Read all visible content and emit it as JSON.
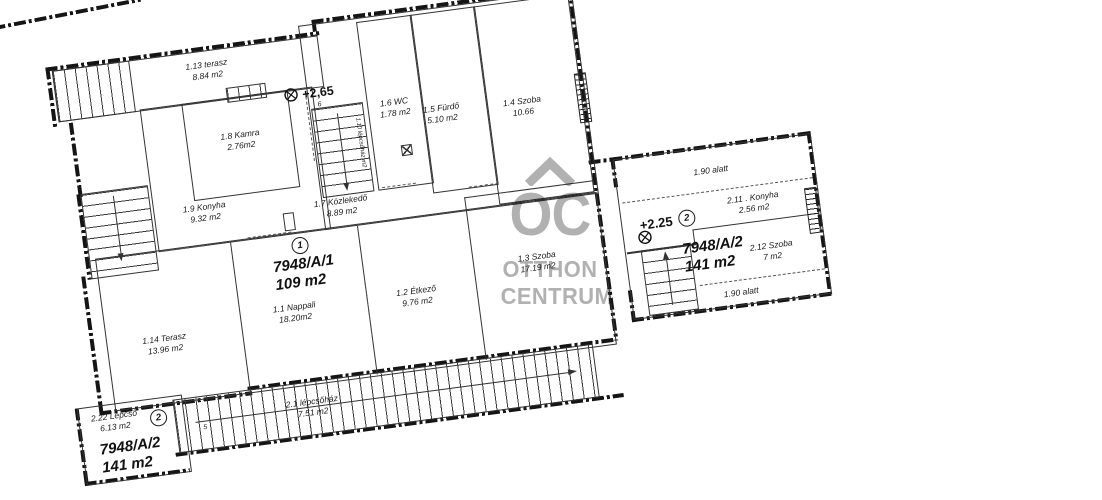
{
  "watermark": {
    "logo_text": "OC",
    "line1": "OTTHON",
    "line2": "CENTRUM",
    "color": "#b1b1b1"
  },
  "units": {
    "unit1": {
      "id": "7948/A/1",
      "area": "109 m2",
      "badge": "1",
      "level": "+2,65",
      "level_note": "6"
    },
    "unit2": {
      "id": "7948/A/2",
      "area": "141 m2",
      "badge": "2",
      "level": "+2.25"
    },
    "unit2_bottom": {
      "id": "7948/A/2",
      "area": "141 m2",
      "badge": "2"
    }
  },
  "rooms": {
    "terasz113": {
      "name": "1.13 terasz",
      "area": "8.84 m2"
    },
    "kamra18": {
      "name": "1.8 Kamra",
      "area": "2.76m2"
    },
    "konyha19": {
      "name": "1.9 Konyha",
      "area": "9.32 m2"
    },
    "lepcsohaz110": {
      "name": "1.10 lépcsőház",
      "area": "m2"
    },
    "wc16": {
      "name": "1.6 WC",
      "area": "1.78 m2"
    },
    "furdo15": {
      "name": "1.5 Fürdő",
      "area": "5.10 m2"
    },
    "szoba14": {
      "name": "1.4 Szoba",
      "area": "10.66"
    },
    "kozlekedo17": {
      "name": "1.7 Közlekedő",
      "area": "8.89 m2"
    },
    "nappali11": {
      "name": "1.1 Nappali",
      "area": "18.20m2"
    },
    "etkezo12": {
      "name": "1.2 Étkező",
      "area": "9.76 m2"
    },
    "szoba13": {
      "name": "1.3 Szoba",
      "area": "17.19 m2"
    },
    "terasz114": {
      "name": "1.14 Terasz",
      "area": "13.96 m2"
    },
    "lepcsohaz21": {
      "name": "2.1 lépcsőház",
      "area": "7.51 m2"
    },
    "lepcso222": {
      "name": "2.22 Lépcső",
      "area": "6.13 m2"
    },
    "konyha211": {
      "name": "2.11 . Konyha",
      "area": "2.56 m2"
    },
    "szoba212": {
      "name": "2.12 Szoba",
      "area": "7 m2"
    }
  },
  "annotations": {
    "under_190_top": "1.90 alatt",
    "under_190_bottom": "1.90 alatt",
    "stair_number": "5"
  }
}
